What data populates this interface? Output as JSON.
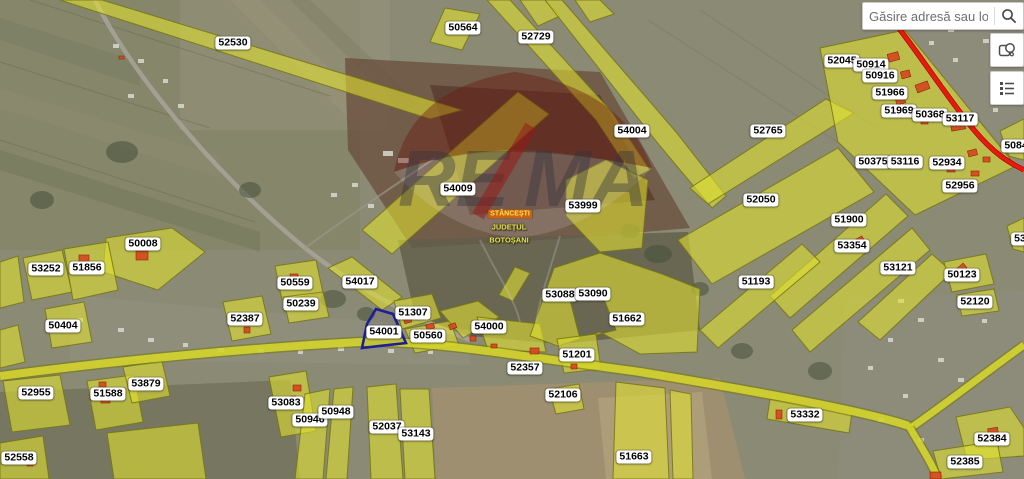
{
  "search": {
    "placeholder": "Găsire adresă sau loc",
    "icon": "magnifier-icon"
  },
  "toolbar": {
    "buttons": [
      {
        "name": "basemap",
        "icon": "basemap-gallery-icon"
      },
      {
        "name": "legend",
        "icon": "legend-list-icon"
      }
    ]
  },
  "watermark": {
    "left": "RE",
    "slash": "/",
    "right": "MA"
  },
  "map": {
    "selected_parcel": "54001",
    "place_labels": {
      "locality": "STÂNCEȘTI",
      "county_line1": "JUDEȚUL",
      "county_line2": "BOTOȘANI"
    },
    "parcel_labels": [
      {
        "id": "52530",
        "x": 233,
        "y": 43
      },
      {
        "id": "50564",
        "x": 463,
        "y": 28
      },
      {
        "id": "52729",
        "x": 536,
        "y": 37
      },
      {
        "id": "54004",
        "x": 632,
        "y": 131
      },
      {
        "id": "52045",
        "x": 842,
        "y": 61
      },
      {
        "id": "50914",
        "x": 871,
        "y": 65
      },
      {
        "id": "50916",
        "x": 880,
        "y": 76
      },
      {
        "id": "51966",
        "x": 890,
        "y": 93
      },
      {
        "id": "51969",
        "x": 899,
        "y": 111
      },
      {
        "id": "50368",
        "x": 930,
        "y": 115
      },
      {
        "id": "53117",
        "x": 960,
        "y": 119
      },
      {
        "id": "52765",
        "x": 768,
        "y": 131
      },
      {
        "id": "50375",
        "x": 873,
        "y": 162
      },
      {
        "id": "53116",
        "x": 905,
        "y": 162
      },
      {
        "id": "52934",
        "x": 947,
        "y": 163
      },
      {
        "id": "5084",
        "x": 1016,
        "y": 146
      },
      {
        "id": "52956",
        "x": 960,
        "y": 186
      },
      {
        "id": "52050",
        "x": 761,
        "y": 200
      },
      {
        "id": "51900",
        "x": 849,
        "y": 220
      },
      {
        "id": "53354",
        "x": 852,
        "y": 246
      },
      {
        "id": "53121",
        "x": 898,
        "y": 268
      },
      {
        "id": "50123",
        "x": 962,
        "y": 275
      },
      {
        "id": "52120",
        "x": 975,
        "y": 302
      },
      {
        "id": "53",
        "x": 1020,
        "y": 239
      },
      {
        "id": "51193",
        "x": 756,
        "y": 282
      },
      {
        "id": "54009",
        "x": 458,
        "y": 189
      },
      {
        "id": "53999",
        "x": 583,
        "y": 206
      },
      {
        "id": "50008",
        "x": 143,
        "y": 244
      },
      {
        "id": "53252",
        "x": 46,
        "y": 269
      },
      {
        "id": "51856",
        "x": 87,
        "y": 268
      },
      {
        "id": "50404",
        "x": 63,
        "y": 326
      },
      {
        "id": "50559",
        "x": 295,
        "y": 283
      },
      {
        "id": "50239",
        "x": 301,
        "y": 304
      },
      {
        "id": "52387",
        "x": 245,
        "y": 319
      },
      {
        "id": "54017",
        "x": 360,
        "y": 282
      },
      {
        "id": "51307",
        "x": 413,
        "y": 313
      },
      {
        "id": "54001",
        "x": 384,
        "y": 332
      },
      {
        "id": "50560",
        "x": 428,
        "y": 336
      },
      {
        "id": "54000",
        "x": 489,
        "y": 327
      },
      {
        "id": "53088",
        "x": 560,
        "y": 295
      },
      {
        "id": "53090",
        "x": 593,
        "y": 294
      },
      {
        "id": "51662",
        "x": 627,
        "y": 319
      },
      {
        "id": "51201",
        "x": 577,
        "y": 355
      },
      {
        "id": "52357",
        "x": 525,
        "y": 368
      },
      {
        "id": "52106",
        "x": 563,
        "y": 395
      },
      {
        "id": "52955",
        "x": 36,
        "y": 393
      },
      {
        "id": "51588",
        "x": 108,
        "y": 394
      },
      {
        "id": "53879",
        "x": 146,
        "y": 384
      },
      {
        "id": "53083",
        "x": 286,
        "y": 403
      },
      {
        "id": "50946",
        "x": 310,
        "y": 420
      },
      {
        "id": "50948",
        "x": 336,
        "y": 412
      },
      {
        "id": "52037",
        "x": 387,
        "y": 427
      },
      {
        "id": "53143",
        "x": 416,
        "y": 434
      },
      {
        "id": "51663",
        "x": 634,
        "y": 457
      },
      {
        "id": "53332",
        "x": 805,
        "y": 415
      },
      {
        "id": "52384",
        "x": 992,
        "y": 439
      },
      {
        "id": "52385",
        "x": 965,
        "y": 462
      },
      {
        "id": "52558",
        "x": 19,
        "y": 458
      }
    ]
  },
  "colors": {
    "parcel_fill": "#e2e230",
    "parcel_outline": "#747410",
    "selected_outline": "#1e1e96",
    "road_line": "#e51c0c",
    "building": "#d44a1e",
    "label_bg": "#ffffff",
    "label_text": "#000000",
    "locality_bg": "#c86414",
    "locality_text": "#ffe14a",
    "county_text": "#e8e050"
  }
}
